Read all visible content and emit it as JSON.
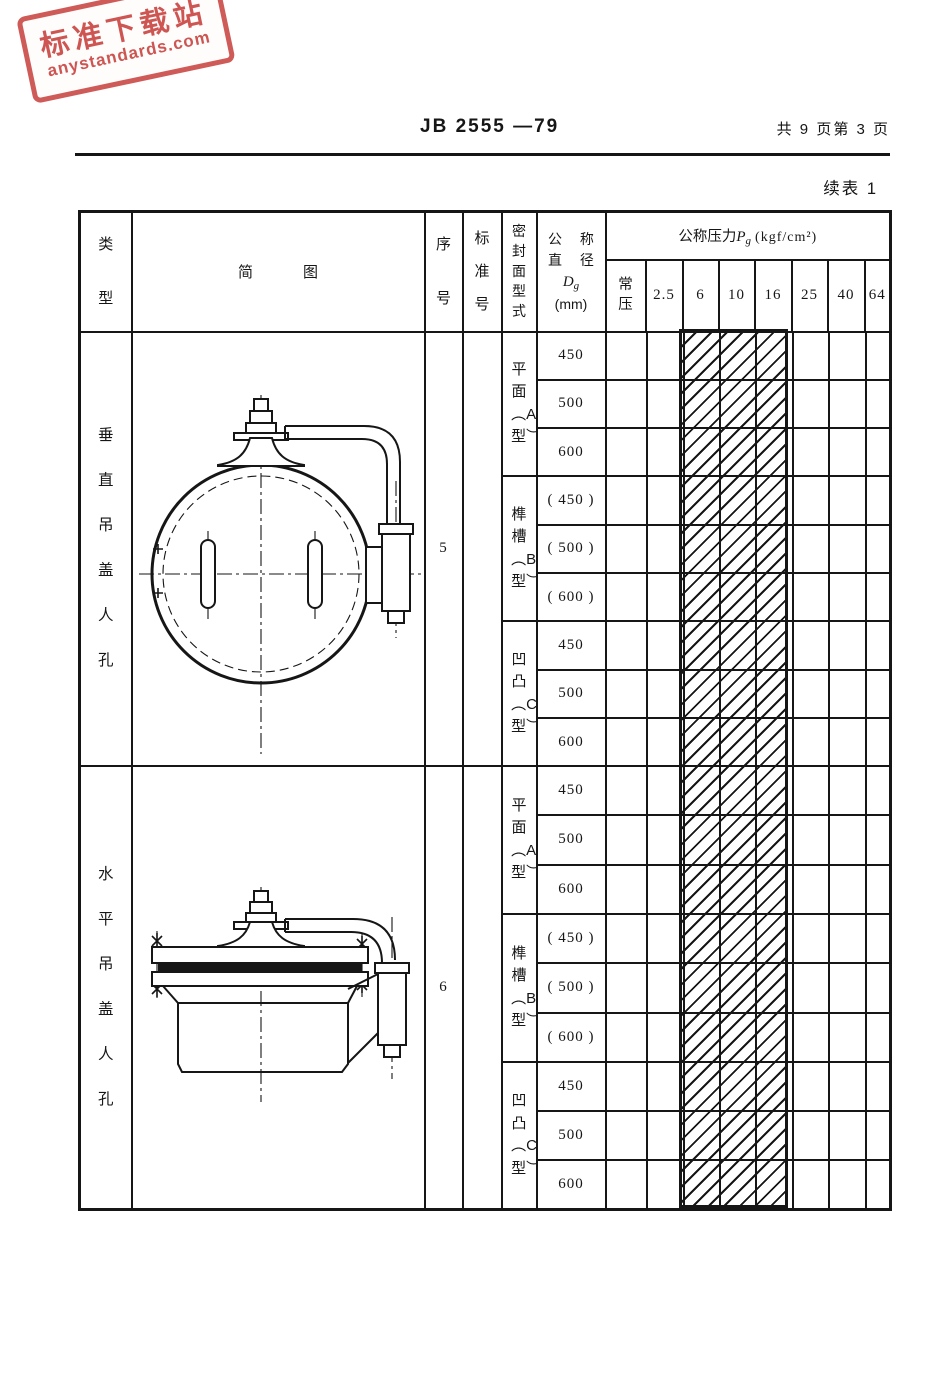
{
  "page": {
    "doc_number": "JB 2555 —79",
    "page_info": "共 9 页第 3 页",
    "table_caption": "续表 1"
  },
  "watermark": {
    "line1": "标准下载站",
    "line2": "anystandards.com",
    "color": "#c63e3a"
  },
  "table": {
    "header": {
      "col_type": "类型",
      "col_diagram": "简图",
      "col_serial": "序号",
      "col_standard": "标准号",
      "col_seal": "密封面型式",
      "dia_line1": "公 称",
      "dia_line2": "直 径",
      "dia_symbol_main": "D",
      "dia_symbol_sub": "g",
      "dia_unit": "(mm)",
      "pressure_prefix": "公称压力",
      "pressure_symbol_main": "P",
      "pressure_symbol_sub": "g",
      "pressure_unit": "(kgf/cm²)",
      "pressure_cols": [
        "常压",
        "2.5",
        "6",
        "10",
        "16",
        "25",
        "40",
        "64"
      ]
    },
    "hatched_pressure_cols": [
      "6",
      "10",
      "16"
    ],
    "rows": [
      {
        "type": "垂直吊盖人孔",
        "serial": "5",
        "standard": "JB 582 —79",
        "diagram": "vertical-hinged-cover-manhole-front-view",
        "seal_groups": [
          {
            "label": "平面︵A型︶",
            "diameters": [
              "450",
              "500",
              "600"
            ]
          },
          {
            "label": "榫槽︵B型︶",
            "diameters": [
              "( 450 )",
              "( 500 )",
              "( 600 )"
            ]
          },
          {
            "label": "凹凸︵C型︶",
            "diameters": [
              "450",
              "500",
              "600"
            ]
          }
        ]
      },
      {
        "type": "水平吊盖人孔",
        "serial": "6",
        "standard": "JB 583 —79",
        "diagram": "horizontal-hinged-cover-manhole-side-view",
        "seal_groups": [
          {
            "label": "平面︵A型︶",
            "diameters": [
              "450",
              "500",
              "600"
            ]
          },
          {
            "label": "榫槽︵B型︶",
            "diameters": [
              "( 450 )",
              "( 500 )",
              "( 600 )"
            ]
          },
          {
            "label": "凹凸︵C型︶",
            "diameters": [
              "450",
              "500",
              "600"
            ]
          }
        ]
      }
    ]
  },
  "colors": {
    "ink": "#161616",
    "paper": "#ffffff",
    "stamp_red": "#c63e3a"
  }
}
